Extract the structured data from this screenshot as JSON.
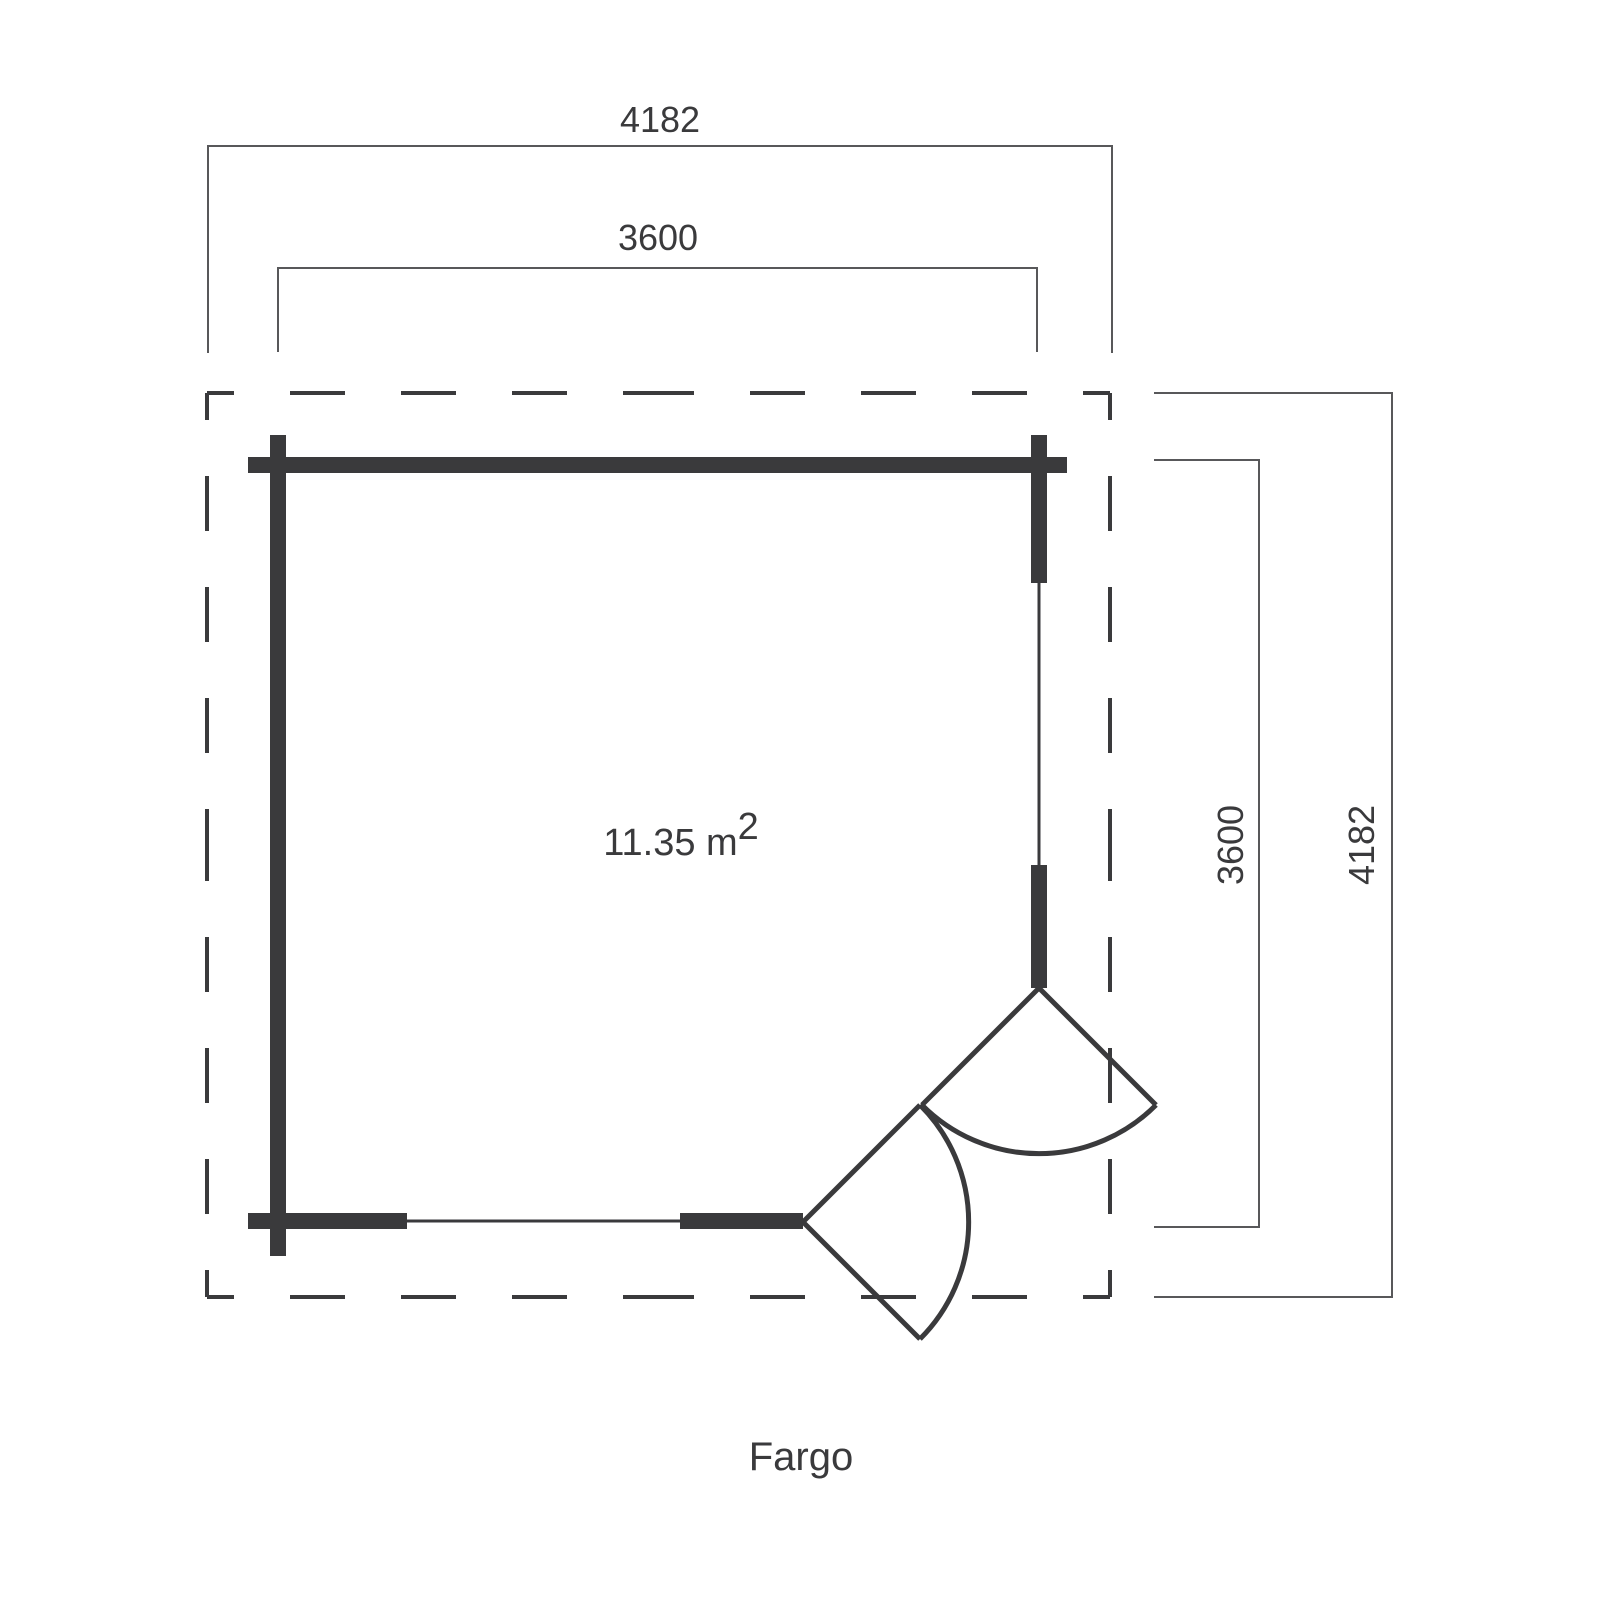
{
  "plan": {
    "title": "Fargo",
    "area": {
      "value": "11.35 m",
      "superscript": "2"
    },
    "dimensions": {
      "top_outer": "4182",
      "top_inner": "3600",
      "right_inner": "3600",
      "right_outer": "4182"
    },
    "colors": {
      "ink": "#3a3a3c",
      "dimension_line": "#58585a",
      "background": "#ffffff"
    }
  }
}
